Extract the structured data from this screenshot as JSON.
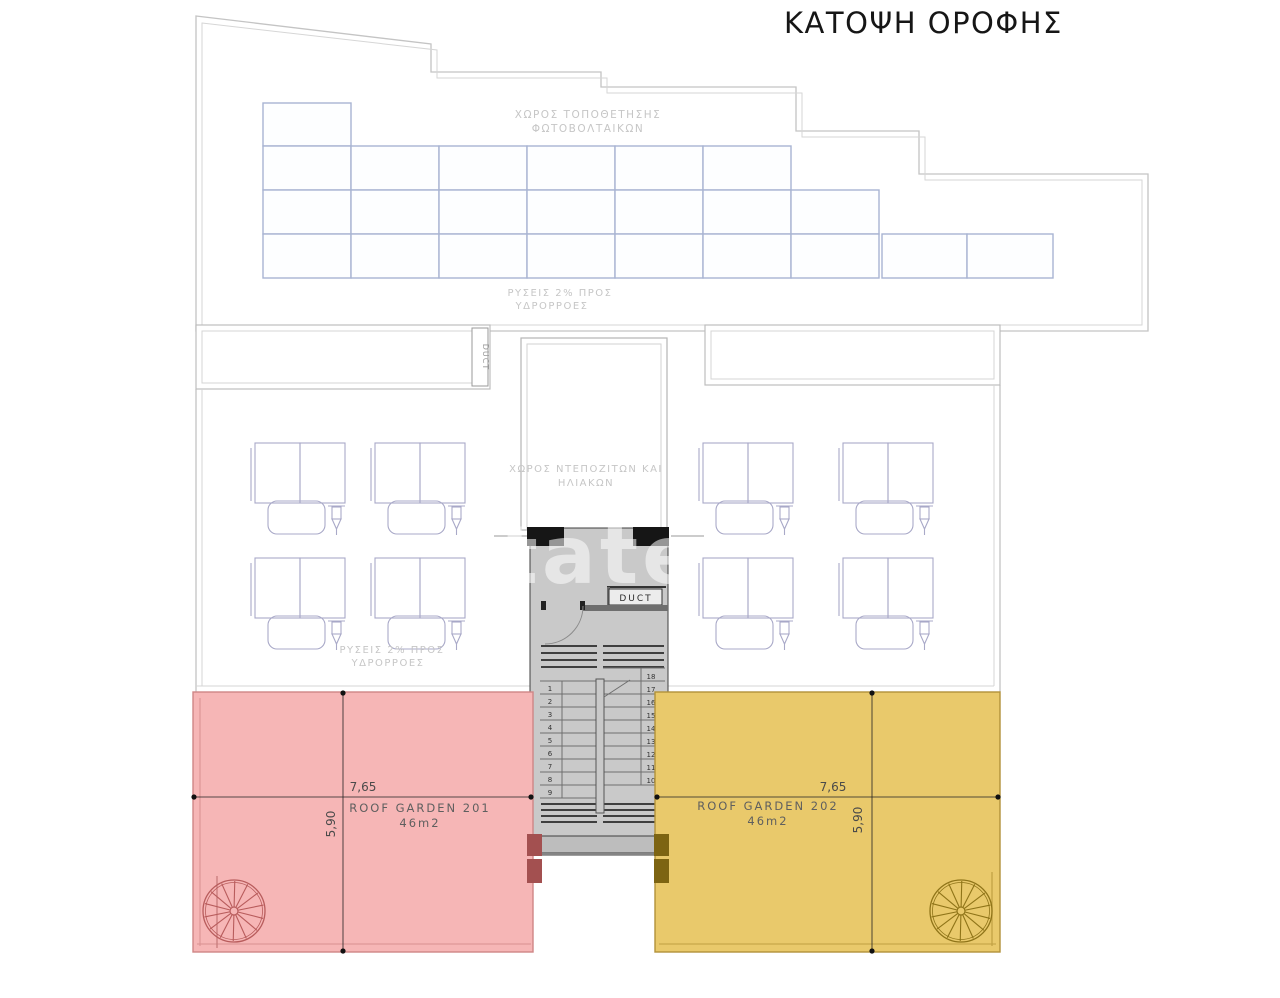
{
  "title": "ΚΑΤΟΨΗ ΟΡΟΦΗΣ",
  "labels": {
    "pv1": "ΧΩΡΟΣ ΤΟΠΟΘΕΤΗΣΗΣ",
    "pv2": "ΦΩΤΟΒΟΛΤΑΙΚΩΝ",
    "slope_up1": "ΡΥΣΕΙΣ 2% ΠΡΟΣ",
    "slope_up2": "ΥΔΡΟΡΡΟΕΣ",
    "tanks1": "ΧΩΡΟΣ ΝΤΕΠΟΖΙΤΩΝ ΚΑΙ",
    "tanks2": "ΗΛΙΑΚΩΝ",
    "slope_low1": "ΡΥΣΕΙΣ 2% ΠΡΟΣ",
    "slope_low2": "ΥΔΡΟΡΡΟΕΣ",
    "duct_band": "DUCT",
    "duct_shaft": "DUCT",
    "watermark": "tate"
  },
  "gardens": [
    {
      "name": "ROOF GARDEN 201",
      "area": "46m2",
      "width": "7,65",
      "height": "5,90",
      "color": "#f6b6b6",
      "border": "#cf8585",
      "accent": "#a35050",
      "stair_color": "#b85c5c"
    },
    {
      "name": "ROOF GARDEN 202",
      "area": "46m2",
      "width": "7,65",
      "height": "5,90",
      "color": "#e9c96b",
      "border": "#b2923a",
      "accent": "#7d6412",
      "stair_color": "#8f7418"
    }
  ],
  "stair": {
    "left_numbers": [
      "1",
      "2",
      "3",
      "4",
      "5",
      "6",
      "7",
      "8",
      "9"
    ],
    "right_numbers": [
      "18",
      "17",
      "16",
      "15",
      "14",
      "13",
      "12",
      "11",
      "10"
    ]
  },
  "colors": {
    "panel_line": "#a9b4d2",
    "panel_fill": "#fdfeff",
    "outline_gray": "#c6c6c6",
    "shaft_fill": "#c9c9c9",
    "wall_black": "#161616",
    "solar_line": "#a9a9c8"
  },
  "geometry": {
    "pv_cell_w": 88,
    "pv_rows": [
      {
        "x": 263,
        "y": 103,
        "h": 43,
        "cols": 1
      },
      {
        "x": 263,
        "y": 146,
        "h": 44,
        "cols": 6
      },
      {
        "x": 263,
        "y": 190,
        "h": 44,
        "cols": 7
      },
      {
        "x": 263,
        "y": 234,
        "h": 44,
        "cols": 7
      }
    ],
    "pv_extra": [
      {
        "x": 882,
        "y": 234,
        "w": 85,
        "h": 44
      },
      {
        "x": 967,
        "y": 234,
        "w": 86,
        "h": 44
      }
    ],
    "solar_units": [
      [
        255,
        443
      ],
      [
        375,
        443
      ],
      [
        255,
        558
      ],
      [
        375,
        558
      ],
      [
        703,
        443
      ],
      [
        843,
        443
      ],
      [
        703,
        558
      ],
      [
        843,
        558
      ]
    ],
    "spirals": [
      {
        "cx": 234,
        "cy": 911,
        "r": 31,
        "garden": 0
      },
      {
        "cx": 961,
        "cy": 911,
        "r": 31,
        "garden": 1
      }
    ]
  }
}
